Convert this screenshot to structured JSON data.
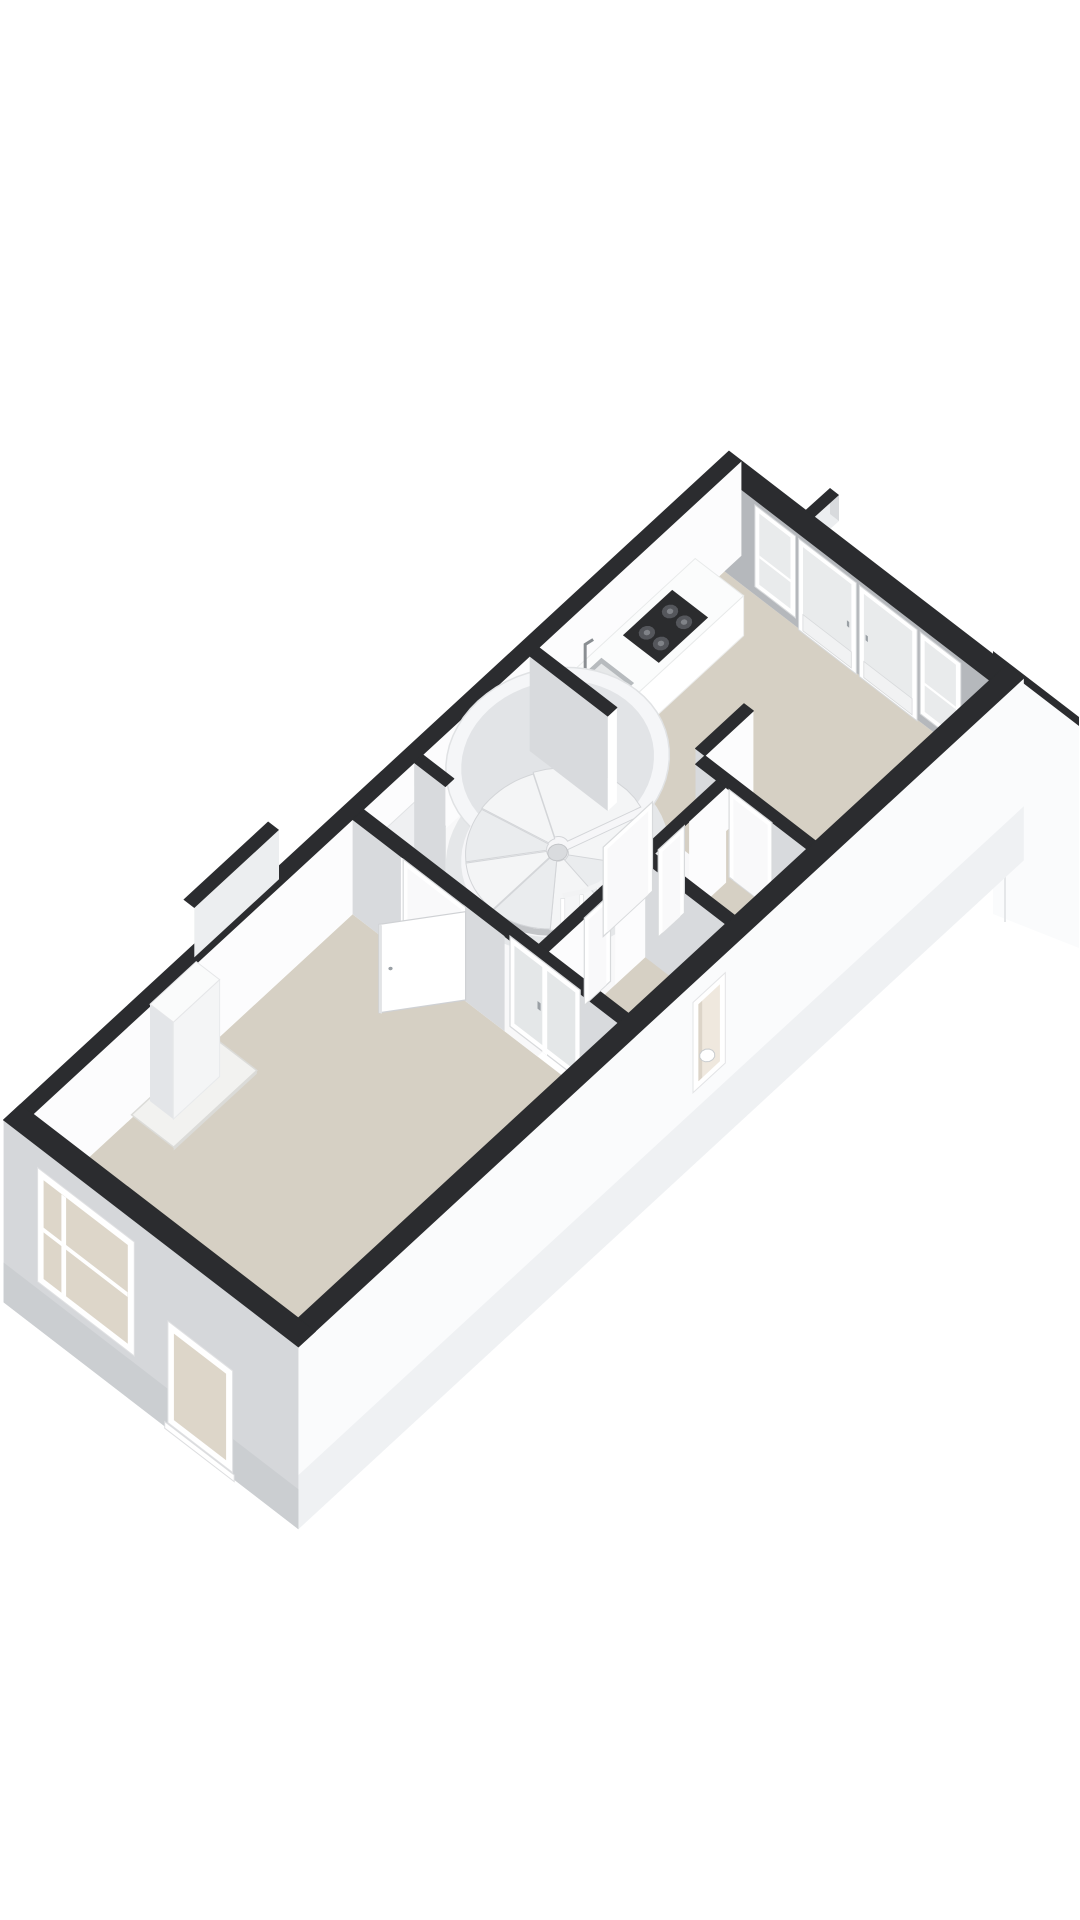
{
  "app": {
    "name": "3d-floorplan-render",
    "description": "Isometric 3D cut-away floor plan of a long narrow apartment floor, white background, no visible text",
    "visible_text": []
  },
  "colors": {
    "background": "#ffffff",
    "cap": "#2b2c2f",
    "capSoft": "#3a3b3e",
    "floorBeige": "#d6d0c4",
    "floorBeigeDark": "#cfc9bd",
    "floorWhite": "#f8f8f9",
    "wallLight": "#fcfcfd",
    "wallShade": "#d8dadd",
    "wallShadeDark": "#c7cacd",
    "kitchenRearFace": "#b5b8bc",
    "facadeFront": "#d5d7da",
    "facadeFrontLow": "#cbced1",
    "facadeRight": "#fafbfc",
    "facadeRightLow": "#eff1f3",
    "sliverLight": "#eceef0",
    "frameWhite": "#ffffff",
    "frameEdge": "#d8dadc",
    "glassBeige": "#ddd6c9",
    "glassPale": "#e9ebec",
    "doorPanel": "#f1f2f3",
    "counterFront": "#ffffff",
    "counterTop": "#fbfcfc",
    "counterEnd": "#edeff1",
    "cooktop": "#2b2c2e",
    "burner": "#55575c",
    "sinkRim": "#b7bbbe",
    "sinkBasin": "#e6e8e9",
    "shellTop": "#f5f6f8",
    "shellSide": "#e5e7e9",
    "shellInner": "#e2e4e7",
    "shaftFloor": "#f6f6f8",
    "stepA": "#f4f5f6",
    "stepB": "#eaecee",
    "stepEdge": "#d3d5d8",
    "voidGray": "#c3c5c8",
    "pole": "#d9dbde",
    "hearth": "#f2f2f0",
    "hearthEdge": "#dbdbd8",
    "chimneyFace": "#f4f5f6",
    "chimneySide": "#e3e5e8",
    "nicheReveal": "#efe8de",
    "nicheJamb": "#dcd4c8"
  },
  "projection": {
    "origin": [
      33,
      1209
    ],
    "eU": [
      77,
      -71
    ],
    "eV": [
      78,
      60
    ],
    "ez": 95
  },
  "building": {
    "length": 9.2,
    "width": 3.4,
    "wall_height": 1,
    "ext_thickness": 0.22,
    "plinth": 0.92
  },
  "floors": [
    {
      "name": "living-room-floor",
      "x0": 0,
      "y0": 0,
      "x1": 4.15,
      "y1": 3.4,
      "fill": "floorBeige"
    },
    {
      "name": "hallway-floor",
      "x0": 4.15,
      "y0": 0,
      "x1": 6.72,
      "y1": 2.37,
      "fill": "floorWhite"
    },
    {
      "name": "toilet-floor",
      "x0": 4.29,
      "y0": 2.37,
      "x1": 5.67,
      "y1": 3.4,
      "fill": "floorBeige"
    },
    {
      "name": "inner-hall-floor",
      "x0": 5.67,
      "y0": 2.25,
      "x1": 6.72,
      "y1": 3.4,
      "fill": "floorBeige"
    },
    {
      "name": "kitchen-floor",
      "x0": 6.6,
      "y0": 0,
      "x1": 8.98,
      "y1": 3.4,
      "fill": "floorBeige"
    }
  ],
  "walls": {
    "rear": {
      "x0": 8.98,
      "y0": 0,
      "x1": 9.2,
      "y1": 3.4,
      "nx": "kitchenRearFace"
    },
    "left": {
      "x0": -0.22,
      "y0": -0.16,
      "x1": 9.2,
      "y1": 0,
      "py": "wallLight",
      "nx": "sliverLight"
    },
    "right": {
      "x0": -0.22,
      "y0": 3.4,
      "x1": 9.2,
      "y1": 3.62,
      "py": "facadeRight",
      "nx": "sliverLight",
      "plinth": true
    },
    "front": {
      "x0": -0.22,
      "y0": -0.16,
      "x1": 0,
      "y1": 3.62,
      "nx": "facadeFront",
      "plinth": true
    }
  },
  "partitions": [
    {
      "name": "kitchen-stub-wall",
      "x0": 6.45,
      "y0": 0,
      "x1": 6.57,
      "y1": 1.0,
      "nx": "wallShade",
      "py": "frameWhite"
    },
    {
      "name": "kitchen-entry-wall",
      "x0": 6.72,
      "y0": 1.86,
      "x1": 7.35,
      "y1": 1.98,
      "nx": "wallShade",
      "py": "wallLight"
    },
    {
      "name": "innerhall-side-wall-a",
      "x0": 6.6,
      "y0": 1.98,
      "x1": 6.72,
      "y1": 2.35,
      "nx": "wallShade",
      "capSpan": [
        6.6,
        1.98,
        6.72,
        3.4
      ]
    },
    {
      "name": "innerhall-side-wall-b",
      "x0": 6.6,
      "y0": 2.9,
      "x1": 6.72,
      "y1": 3.4,
      "nx": "wallShade",
      "cap": false
    },
    {
      "name": "innerhall-front-wall-a",
      "x0": 5.67,
      "y0": 2.25,
      "x1": 5.78,
      "y1": 2.37,
      "nx": "wallShade",
      "capSpan": [
        5.67,
        2.25,
        6.6,
        2.37
      ]
    },
    {
      "name": "innerhall-front-wall-b",
      "x0": 6.12,
      "y0": 2.25,
      "x1": 6.6,
      "y1": 2.37,
      "py": "wallLight",
      "cap": false
    },
    {
      "name": "toilet-side-wall",
      "x0": 5.55,
      "y0": 2.25,
      "x1": 5.67,
      "y1": 3.4,
      "nx": "wallShade"
    },
    {
      "name": "toilet-front-wall-a",
      "x0": 4.29,
      "y0": 2.25,
      "x1": 4.82,
      "y1": 2.37,
      "py": "wallLight",
      "capSpan": [
        4.29,
        2.25,
        5.55,
        2.37
      ]
    },
    {
      "name": "toilet-front-wall-b",
      "x0": 5.16,
      "y0": 2.25,
      "x1": 5.55,
      "y1": 2.37,
      "py": "wallLight",
      "cap": false
    },
    {
      "name": "hall-closet-stub",
      "x0": 4.95,
      "y0": 0,
      "x1": 5.06,
      "y1": 0.4,
      "nx": "wallShade"
    },
    {
      "name": "living-partition-a",
      "x0": 4.15,
      "y0": 0,
      "x1": 4.29,
      "y1": 0.62,
      "nx": "wallShade",
      "py": "frameWhite",
      "capSpan": [
        4.15,
        0,
        4.29,
        3.4
      ]
    },
    {
      "name": "living-partition-b",
      "x0": 4.15,
      "y0": 1.42,
      "x1": 4.29,
      "y1": 1.95,
      "nx": "wallShade",
      "cap": false
    },
    {
      "name": "living-partition-c",
      "x0": 4.15,
      "y0": 2.85,
      "x1": 4.29,
      "y1": 3.4,
      "nx": "wallShade",
      "cap": false
    }
  ],
  "door_frames": [
    {
      "name": "toilet-door-frame",
      "plane": "y",
      "at": 2.31,
      "a0": 4.82,
      "a1": 5.16,
      "z0": 0,
      "z1": 0.92
    },
    {
      "name": "innerhall-door-frame",
      "plane": "y",
      "at": 2.31,
      "a0": 5.78,
      "a1": 6.12,
      "z0": 0,
      "z1": 0.92
    },
    {
      "name": "kitchen-door-frame",
      "plane": "x",
      "at": 6.66,
      "a0": 2.35,
      "a1": 2.9,
      "z0": 0,
      "z1": 0.92
    },
    {
      "name": "stair-entry-frame",
      "plane": "y",
      "at": 1.92,
      "a0": 5.46,
      "a1": 6.1,
      "z0": 0,
      "z1": 0.94
    },
    {
      "name": "living-door-frame",
      "plane": "x",
      "at": 4.18,
      "a0": 0.62,
      "a1": 1.42,
      "z0": 0,
      "z1": 0.95
    }
  ],
  "living_door_leaf": {
    "hinge": [
      4.16,
      1.44
    ],
    "end": [
      3.55,
      0.93
    ],
    "height": 0.93
  },
  "glazed_double_door": {
    "plane_x": 4.22,
    "y0": 1.95,
    "y1": 2.85,
    "z0": 0,
    "z1": 0.95,
    "stile": 2.4
  },
  "front_windows": [
    {
      "name": "front-window-large",
      "y0": 0.28,
      "y1": 1.52,
      "z0": -0.42,
      "z1": 0.78,
      "divider": 0.62
    },
    {
      "name": "front-window-small",
      "y0": 1.95,
      "y1": 2.78,
      "z0": -0.85,
      "z1": 0.22,
      "sill": true
    }
  ],
  "rear_panels": [
    {
      "name": "rear-sidelight-left",
      "y0": 0.4,
      "y1": 0.92,
      "z0": 0.1,
      "z1": 0.96,
      "type": "window"
    },
    {
      "name": "rear-french-door-left",
      "y0": 0.96,
      "y1": 1.7,
      "z0": 0,
      "z1": 0.96,
      "type": "door"
    },
    {
      "name": "rear-french-door-right",
      "y0": 1.74,
      "y1": 2.48,
      "z0": 0,
      "z1": 0.96,
      "type": "door"
    },
    {
      "name": "rear-sidelight-right",
      "y0": 2.52,
      "y1": 3.04,
      "z0": 0.1,
      "z1": 0.96,
      "type": "window"
    }
  ],
  "side_niche": {
    "x0": 4.9,
    "x1": 5.32,
    "z0": -0.15,
    "z1": 0.8,
    "inset": 0.07
  },
  "kitchen": {
    "counter": {
      "x0": 6.62,
      "x1": 8.6,
      "depth": 0.62,
      "height": 0.42
    },
    "cooktop": {
      "x0": 7.58,
      "x1": 8.22,
      "y0": 0.08,
      "y1": 0.54
    },
    "sink": {
      "x0": 6.9,
      "x1": 7.28,
      "y0": 0.1,
      "y1": 0.52
    }
  },
  "living_features": {
    "hearth": {
      "x0": 1.28,
      "x1": 2.36,
      "depth": 0.54,
      "height": 0.035
    },
    "chimney": {
      "x0": 1.52,
      "x1": 2.12,
      "depth": 0.3,
      "height": 1.02
    },
    "closet": {
      "x0": 4.2,
      "x1": 4.95,
      "depth": 0.4,
      "height": 0.58,
      "divider": 4.57
    }
  },
  "stair": {
    "center": [
      5.8,
      1.0
    ],
    "r_outer": 1.02,
    "r_inner": 0.88,
    "steps": 7,
    "step_start_deg": 20,
    "step_sweep_deg": 40,
    "void_arc": [
      95,
      170
    ],
    "baluster_arc": [
      58,
      132
    ],
    "balusters": 7,
    "pole_r": 0.09
  },
  "left_wall_notch": {
    "x0": 2.52,
    "x1": 3.62,
    "y0": -0.56,
    "y1": -0.42,
    "z_face": 0.5
  },
  "rear_structures": {
    "party_wall_stub": {
      "cap": [
        [
          779,
          534
        ],
        [
          830,
          488
        ],
        [
          839,
          495
        ],
        [
          788,
          541
        ]
      ],
      "face": [
        [
          788,
          541
        ],
        [
          839,
          495
        ],
        [
          839,
          521
        ],
        [
          788,
          567
        ]
      ],
      "end": [
        [
          830,
          488
        ],
        [
          839,
          495
        ],
        [
          839,
          521
        ],
        [
          830,
          514
        ]
      ]
    },
    "rear_volume": {
      "cap": [
        [
          993,
          651
        ],
        [
          1079,
          717
        ],
        [
          1079,
          726
        ],
        [
          993,
          660
        ]
      ],
      "face": [
        [
          993,
          660
        ],
        [
          1079,
          726
        ],
        [
          1079,
          948
        ],
        [
          993,
          914
        ]
      ],
      "seam": [
        [
          1004,
          668
        ],
        [
          1004,
          922
        ]
      ]
    }
  }
}
